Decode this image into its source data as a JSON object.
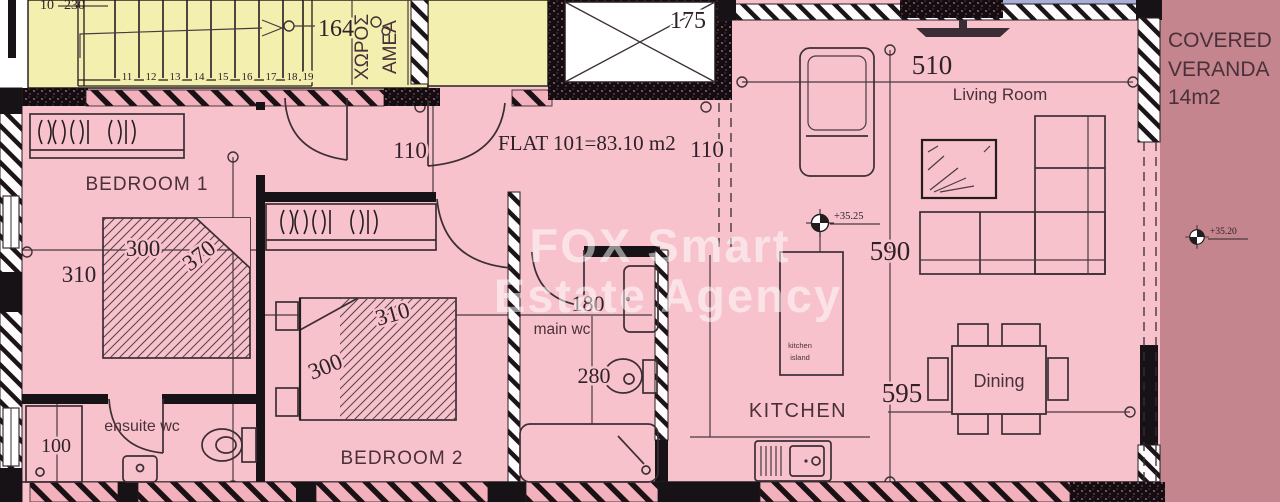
{
  "watermark": {
    "line1": "FOX Smart",
    "line2": "Estate Agency"
  },
  "flat": {
    "title": "FLAT 101=83.10 m2",
    "level": "+35.25"
  },
  "stairwell": {
    "steps": [
      "11",
      "12",
      "13",
      "14",
      "15",
      "16",
      "17",
      "18",
      "19"
    ],
    "dim": "164",
    "top_num": "10",
    "top_dim": "230",
    "area_line1": "ΧΩΡΟΣ",
    "area_line2": "ΑΜΕΑ"
  },
  "elevator": {
    "dim": "175"
  },
  "corridor": {
    "dim_left": "110",
    "dim_right": "110"
  },
  "bedroom1": {
    "name": "BEDROOM 1",
    "dim_top": "300",
    "dim_diag": "370",
    "dim_bottom": "310"
  },
  "bedroom2": {
    "name": "BEDROOM 2",
    "dim_diag_top": "310",
    "dim_diag_bottom": "300"
  },
  "ensuite": {
    "name": "ensuite wc",
    "dim": "100"
  },
  "main_wc": {
    "name": "main wc",
    "dim_width": "180",
    "dim_depth": "280"
  },
  "living_room": {
    "name": "Living Room",
    "dim": "510"
  },
  "kitchen": {
    "name": "KITCHEN",
    "dim_length": "590",
    "dim_width": "595",
    "island_line1": "kitchen",
    "island_line2": "island"
  },
  "dining": {
    "name": "Dining"
  },
  "veranda": {
    "line1": "COVERED",
    "line2": "VERANDA",
    "line3": "14m2",
    "level": "+35.20"
  },
  "colors": {
    "floor_pink": "#f7c2cc",
    "veranda_mauve": "#c4858e",
    "stair_yellow": "#f3efae",
    "wall_black": "#171215",
    "line_dark": "#3c2e35",
    "label_maroon": "#4a3039",
    "watermark_white": "rgba(255,255,255,0.52)",
    "accent_blue": "#a8b0d6"
  }
}
